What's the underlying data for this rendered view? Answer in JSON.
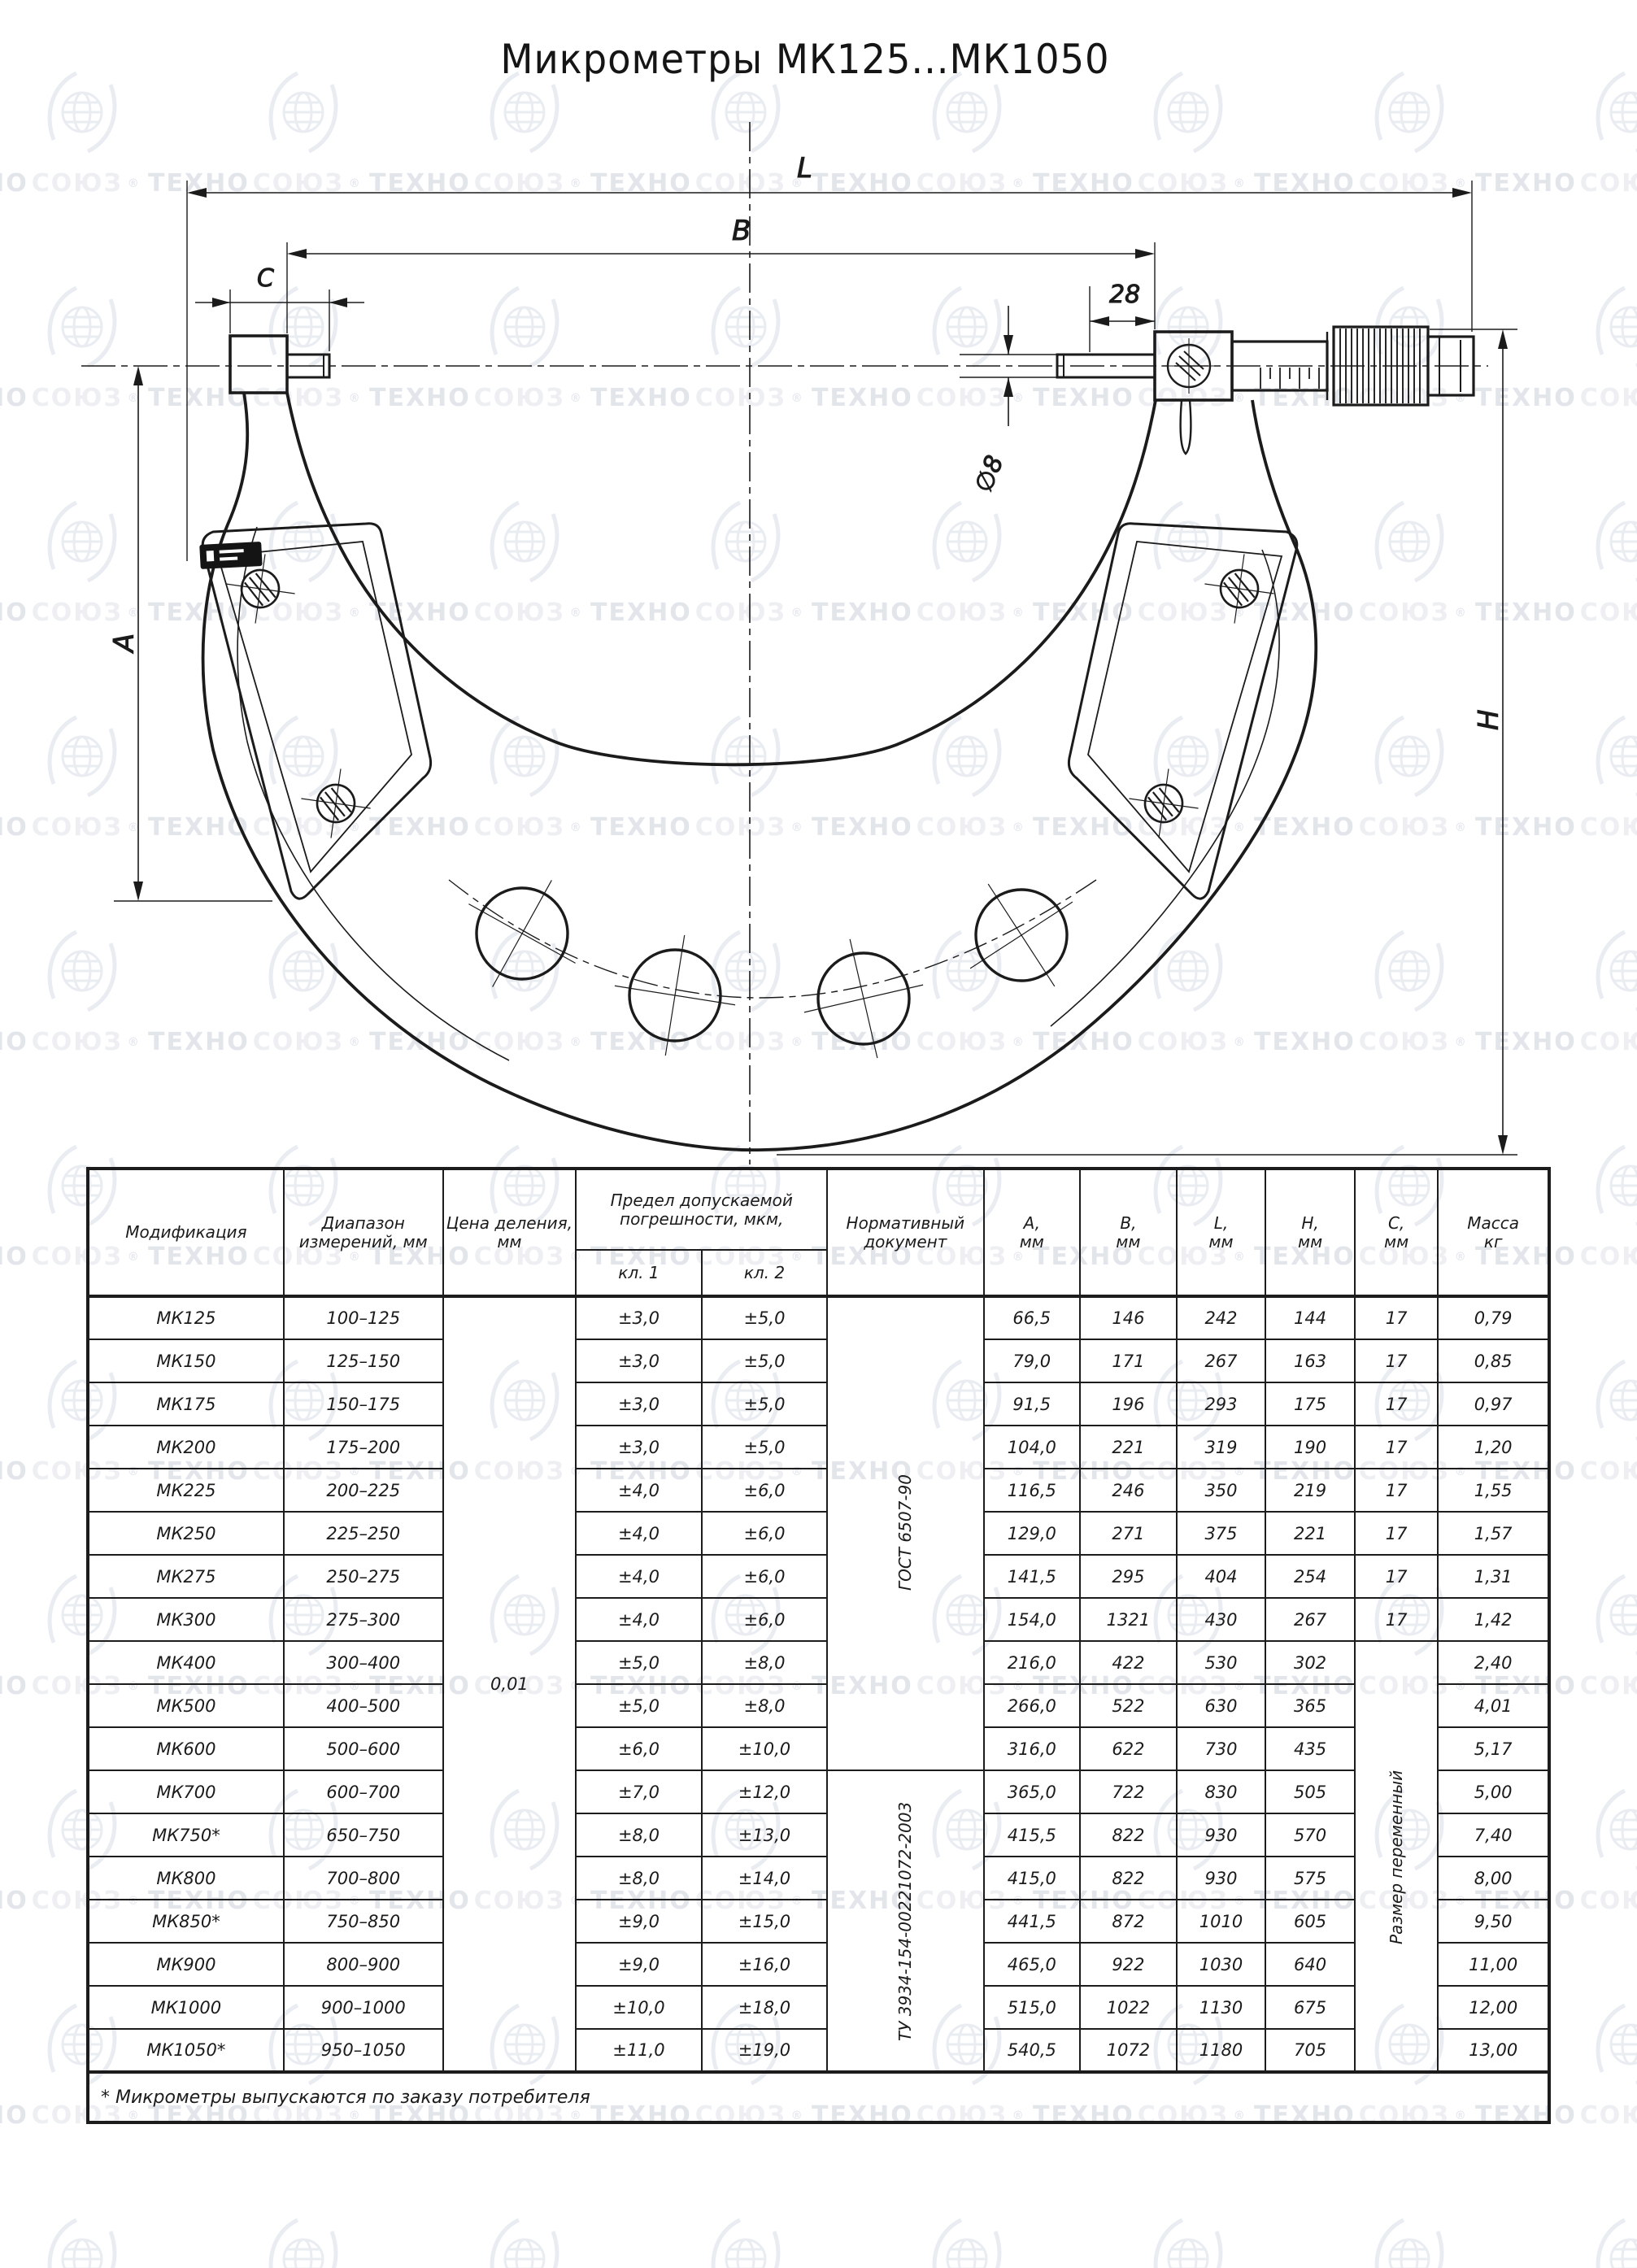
{
  "title": "Микрометры МК125...МК1050",
  "watermark": {
    "t1": "ТЕХНО",
    "t2": "СОЮЗ",
    "reg": "®"
  },
  "drawing": {
    "labels": {
      "L": "L",
      "B": "B",
      "C": "C",
      "len28": "28",
      "dia8": "∅8",
      "A": "A",
      "H": "H"
    }
  },
  "table": {
    "headers": {
      "modification": "Модификация",
      "range": "Диапазон измерений, мм",
      "division": "Цена деления, мм",
      "error": "Предел допускаемой погрешности, мкм,",
      "cl1": "кл. 1",
      "cl2": "кл. 2",
      "norm": "Нормативный документ",
      "dims": [
        {
          "l": "A,",
          "u": "мм"
        },
        {
          "l": "B,",
          "u": "мм"
        },
        {
          "l": "L,",
          "u": "мм"
        },
        {
          "l": "H,",
          "u": "мм"
        },
        {
          "l": "C,",
          "u": "мм"
        },
        {
          "l": "Масса",
          "u": "кг"
        }
      ]
    },
    "merged": {
      "division_value": "0,01",
      "norm_gost": "ГОСТ 6507-90",
      "norm_tu": "ТУ 3934-154-00221072-2003",
      "c_variable": "Размер переменный"
    },
    "rows": [
      [
        "МК125",
        "100–125",
        "±3,0",
        "±5,0",
        "66,5",
        "146",
        "242",
        "144",
        "17",
        "0,79"
      ],
      [
        "МК150",
        "125–150",
        "±3,0",
        "±5,0",
        "79,0",
        "171",
        "267",
        "163",
        "17",
        "0,85"
      ],
      [
        "МК175",
        "150–175",
        "±3,0",
        "±5,0",
        "91,5",
        "196",
        "293",
        "175",
        "17",
        "0,97"
      ],
      [
        "МК200",
        "175–200",
        "±3,0",
        "±5,0",
        "104,0",
        "221",
        "319",
        "190",
        "17",
        "1,20"
      ],
      [
        "МК225",
        "200–225",
        "±4,0",
        "±6,0",
        "116,5",
        "246",
        "350",
        "219",
        "17",
        "1,55"
      ],
      [
        "МК250",
        "225–250",
        "±4,0",
        "±6,0",
        "129,0",
        "271",
        "375",
        "221",
        "17",
        "1,57"
      ],
      [
        "МК275",
        "250–275",
        "±4,0",
        "±6,0",
        "141,5",
        "295",
        "404",
        "254",
        "17",
        "1,31"
      ],
      [
        "МК300",
        "275–300",
        "±4,0",
        "±6,0",
        "154,0",
        "1321",
        "430",
        "267",
        "17",
        "1,42"
      ],
      [
        "МК400",
        "300–400",
        "±5,0",
        "±8,0",
        "216,0",
        "422",
        "530",
        "302",
        "",
        "2,40"
      ],
      [
        "МК500",
        "400–500",
        "±5,0",
        "±8,0",
        "266,0",
        "522",
        "630",
        "365",
        "",
        "4,01"
      ],
      [
        "МК600",
        "500–600",
        "±6,0",
        "±10,0",
        "316,0",
        "622",
        "730",
        "435",
        "",
        "5,17"
      ],
      [
        "МК700",
        "600–700",
        "±7,0",
        "±12,0",
        "365,0",
        "722",
        "830",
        "505",
        "",
        "5,00"
      ],
      [
        "МК750*",
        "650–750",
        "±8,0",
        "±13,0",
        "415,5",
        "822",
        "930",
        "570",
        "",
        "7,40"
      ],
      [
        "МК800",
        "700–800",
        "±8,0",
        "±14,0",
        "415,0",
        "822",
        "930",
        "575",
        "",
        "8,00"
      ],
      [
        "МК850*",
        "750–850",
        "±9,0",
        "±15,0",
        "441,5",
        "872",
        "1010",
        "605",
        "",
        "9,50"
      ],
      [
        "МК900",
        "800–900",
        "±9,0",
        "±16,0",
        "465,0",
        "922",
        "1030",
        "640",
        "",
        "11,00"
      ],
      [
        "МК1000",
        "900–1000",
        "±10,0",
        "±18,0",
        "515,0",
        "1022",
        "1130",
        "675",
        "",
        "12,00"
      ],
      [
        "МК1050*",
        "950–1050",
        "±11,0",
        "±19,0",
        "540,5",
        "1072",
        "1180",
        "705",
        "",
        "13,00"
      ]
    ],
    "footnote": "* Микрометры выпускаются по заказу потребителя"
  }
}
